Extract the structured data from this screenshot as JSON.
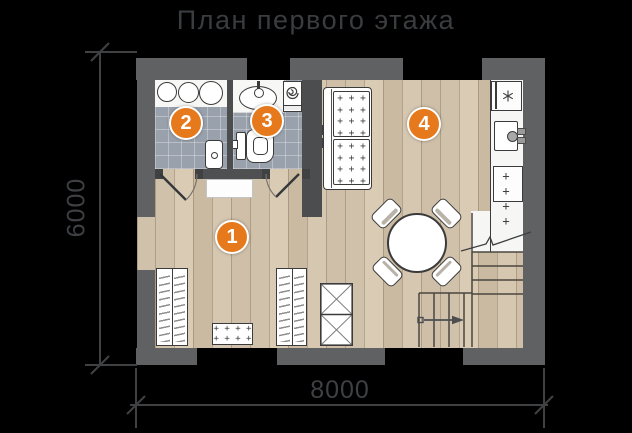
{
  "title": "План первого этажа",
  "dimensions": {
    "width": "8000",
    "height": "6000"
  },
  "rooms": [
    {
      "number": "1",
      "name": "hallway"
    },
    {
      "number": "2",
      "name": "bathroom"
    },
    {
      "number": "3",
      "name": "toilet"
    },
    {
      "number": "4",
      "name": "living-kitchen"
    }
  ],
  "patterns": {
    "sofa_tufting": "+ + +\n+ + +\n+ + +\n+ + +",
    "stove_burners": "+ +\n+ +",
    "mat_dots": "+ + + +\n+ + + +"
  },
  "icons": {
    "fridge": "snowflake-icon",
    "washing_machine": "spiral-drum-icon",
    "stairs": "up-arrow-icon"
  },
  "colors": {
    "background": "#000000",
    "wall": "#5f6163",
    "inner_wall": "#4b4d4f",
    "wood_floor": "#d3c4ae",
    "tile_floor": "#99a1ad",
    "counter": "#f6f6f4",
    "accent_badge": "#e5791b",
    "dimension_line": "#3f4143"
  }
}
